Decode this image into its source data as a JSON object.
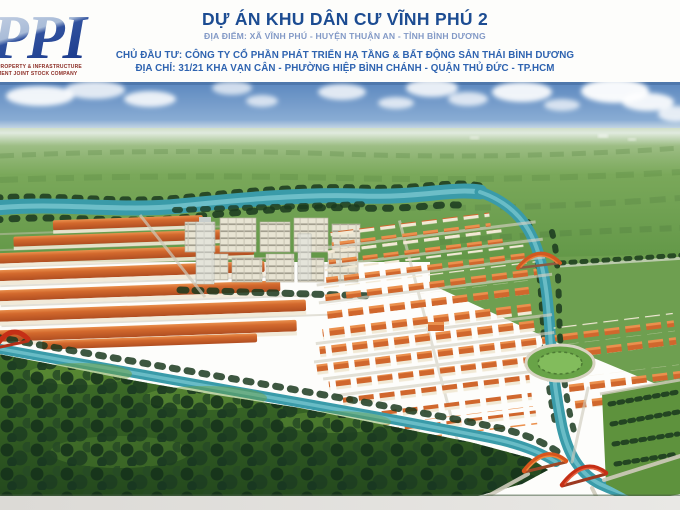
{
  "header": {
    "logo": {
      "acronym": "PPI",
      "tagline_line1": "PROPERTY & INFRASTRUCTURE",
      "tagline_line2": "MENT JOINT STOCK COMPANY"
    },
    "title": "DỰ ÁN KHU DÂN CƯ VĨNH PHÚ 2",
    "location_line": "ĐỊA ĐIỂM: XÃ VĨNH PHÚ - HUYỆN THUẬN AN - TỈNH BÌNH DƯƠNG",
    "investor_line": "CHỦ ĐẦU TƯ: CÔNG TY CỔ PHẦN PHÁT TRIỂN HẠ TẦNG & BẤT ĐỘNG SẢN THÁI BÌNH DƯƠNG",
    "address_line": "ĐỊA CHỈ: 31/21 KHA VẠN CÂN - PHƯỜNG HIỆP BÌNH CHÁNH - QUẬN THỦ ĐỨC - TP.HCM"
  },
  "scene": {
    "palette": {
      "title_blue": "#1c4c92",
      "subtitle_blue": "#8299c6",
      "text_blue": "#2e63b0",
      "logo_navy": "#1c3c8e",
      "logo_red": "#8a2a22",
      "sky_blue": "#5d88bd",
      "field_green": "#6f9e52",
      "forest_green": "#24481e",
      "water_teal": "#3d9aa8",
      "roof_orange": "#cd6830",
      "bridge_red": "#c03018"
    }
  }
}
